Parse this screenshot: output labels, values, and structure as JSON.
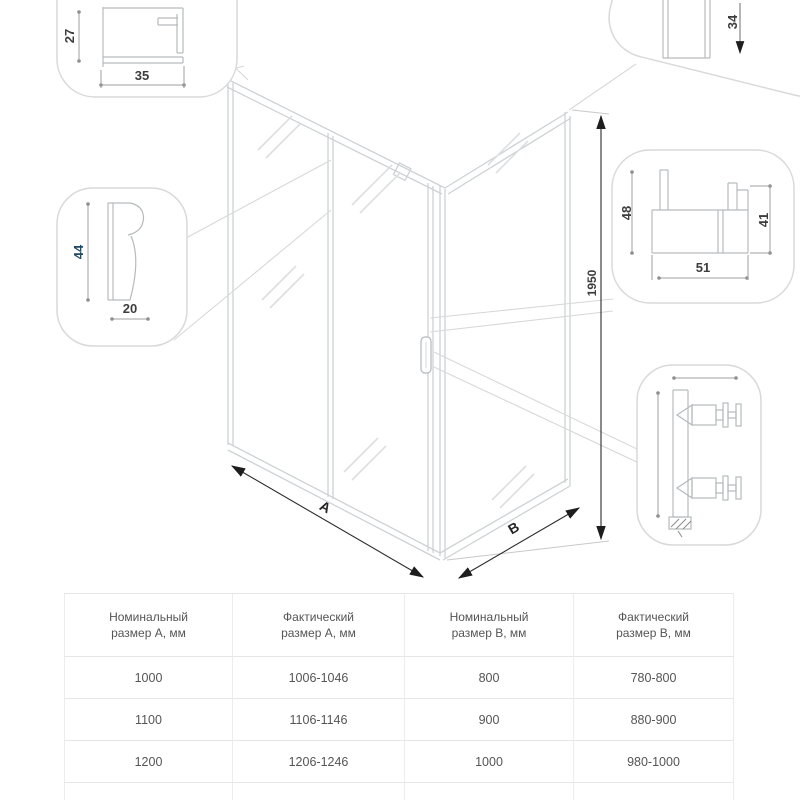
{
  "drawing": {
    "dim_height": "1950",
    "width_label": "A",
    "depth_label": "B",
    "wall_profile": {
      "h": "27",
      "w": "35"
    },
    "frame_profile": {
      "h": "44",
      "w": "20"
    },
    "top_profile": {
      "h": "34"
    },
    "sill_profile": {
      "h": "48",
      "w": "51",
      "h2": "41"
    }
  },
  "table": {
    "headers": [
      {
        "line1": "Номинальный",
        "line2": "размер А, мм"
      },
      {
        "line1": "Фактический",
        "line2": "размер А, мм"
      },
      {
        "line1": "Номинальный",
        "line2": "размер В, мм"
      },
      {
        "line1": "Фактический",
        "line2": "размер В, мм"
      }
    ],
    "rows": [
      [
        "1000",
        "1006-1046",
        "800",
        "780-800"
      ],
      [
        "1100",
        "1106-1146",
        "900",
        "880-900"
      ],
      [
        "1200",
        "1206-1246",
        "1000",
        "980-1000"
      ]
    ]
  },
  "colors": {
    "accent": "#1c4a68"
  }
}
